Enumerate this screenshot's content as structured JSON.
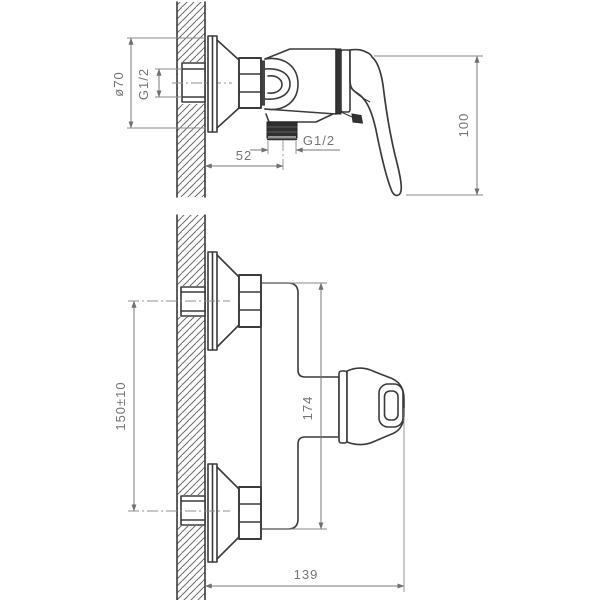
{
  "drawing": {
    "title": "wall-mounted single-lever shower mixer — dimensional drawing",
    "views": [
      {
        "id": "side-view"
      },
      {
        "id": "front-view"
      }
    ],
    "colors": {
      "background": "#ffffff",
      "outline": "#3b3b3b",
      "dark_fill": "#2f2f2f",
      "dimension": "#787878",
      "hatch": "#6a6a6a"
    },
    "dims": {
      "d70": {
        "label": "ø70"
      },
      "g12_inlet": {
        "label": "G1/2"
      },
      "w52": {
        "label": "52"
      },
      "g12_outlet": {
        "label": "G1/2"
      },
      "h100": {
        "label": "100"
      },
      "s150": {
        "label": "150±10"
      },
      "h174": {
        "label": "174"
      },
      "w139": {
        "label": "139"
      }
    }
  }
}
